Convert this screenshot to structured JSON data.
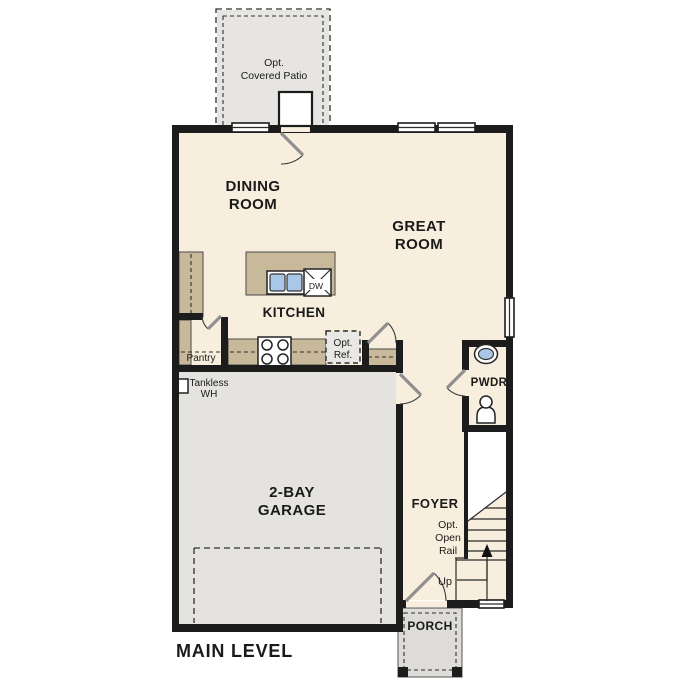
{
  "colors": {
    "floor": "#f7eedd",
    "wall": "#1c1c1c",
    "counter": "#c9b99b",
    "garage": "#e4e3df",
    "patio": "#e6e5e1",
    "porch": "#dedcd8",
    "reffill": "#e9e8e4",
    "sinkblue": "#a9c7e6",
    "stairwhite": "#ffffff",
    "text": "#1a1a1a"
  },
  "title": {
    "main_level": "MAIN LEVEL"
  },
  "rooms": {
    "dining": {
      "l1": "DINING",
      "l2": "ROOM"
    },
    "great": {
      "l1": "GREAT",
      "l2": "ROOM"
    },
    "kitchen": {
      "label": "KITCHEN"
    },
    "garage": {
      "l1": "2-BAY",
      "l2": "GARAGE"
    },
    "foyer": {
      "label": "FOYER"
    },
    "pwdr": {
      "label": "PWDR"
    },
    "porch": {
      "label": "PORCH"
    },
    "pantry": {
      "label": "Pantry"
    }
  },
  "annotations": {
    "covered_patio": {
      "l1": "Opt.",
      "l2": "Covered Patio"
    },
    "opt_ref": {
      "l1": "Opt.",
      "l2": "Ref."
    },
    "open_rail": {
      "l1": "Opt.",
      "l2": "Open",
      "l3": "Rail"
    },
    "tankless": {
      "l1": "Tankless",
      "l2": "WH"
    },
    "up": "Up",
    "dishwasher": "DW"
  }
}
